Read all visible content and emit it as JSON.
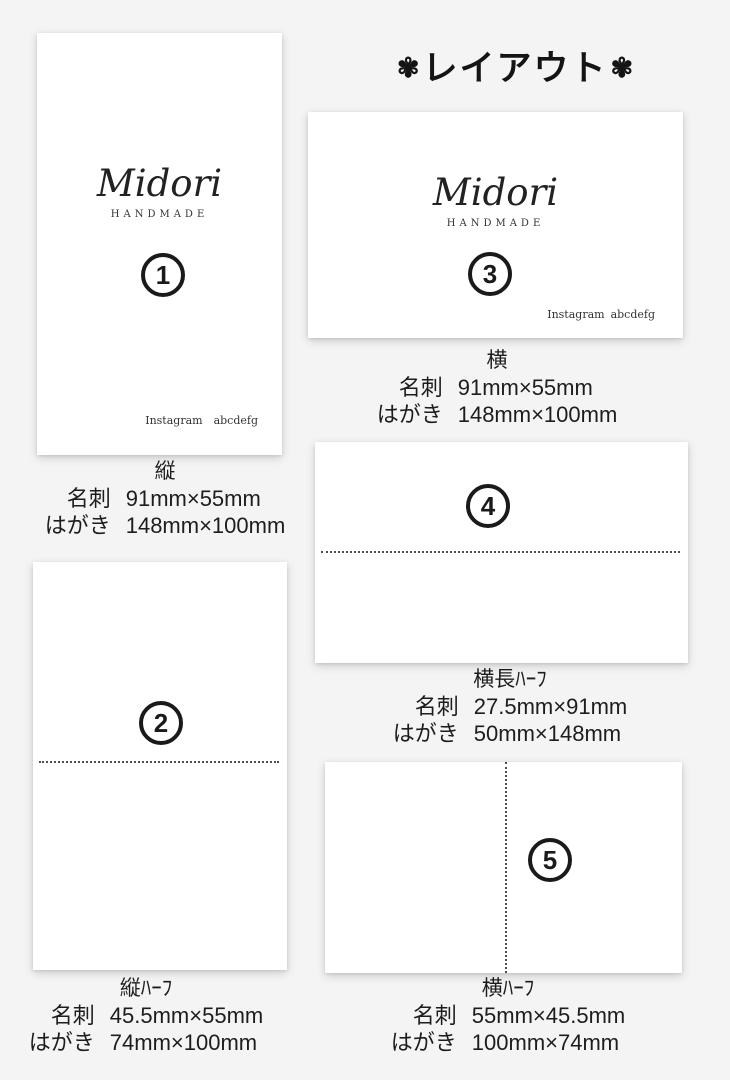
{
  "page": {
    "title": "レイアウト",
    "title_decoration": "✾",
    "background": "#f4f4f4"
  },
  "brand": {
    "name": "Midori",
    "subtitle": "HANDMADE",
    "account_label": "Instagram",
    "account_name": "abcdefg"
  },
  "layouts": [
    {
      "number": "1",
      "label": "縦",
      "meishi_label": "名刺",
      "meishi_value": "91mm×55mm",
      "hagaki_label": "はがき",
      "hagaki_value": "148mm×100mm"
    },
    {
      "number": "2",
      "label": "縦ﾊｰﾌ",
      "meishi_label": "名刺",
      "meishi_value": "45.5mm×55mm",
      "hagaki_label": "はがき",
      "hagaki_value": "74mm×100mm"
    },
    {
      "number": "3",
      "label": "横",
      "meishi_label": "名刺",
      "meishi_value": "91mm×55mm",
      "hagaki_label": "はがき",
      "hagaki_value": "148mm×100mm"
    },
    {
      "number": "4",
      "label": "横長ﾊｰﾌ",
      "meishi_label": "名刺",
      "meishi_value": "27.5mm×91mm",
      "hagaki_label": "はがき",
      "hagaki_value": "50mm×148mm"
    },
    {
      "number": "5",
      "label": "横ﾊｰﾌ",
      "meishi_label": "名刺",
      "meishi_value": "55mm×45.5mm",
      "hagaki_label": "はがき",
      "hagaki_value": "100mm×74mm"
    }
  ]
}
